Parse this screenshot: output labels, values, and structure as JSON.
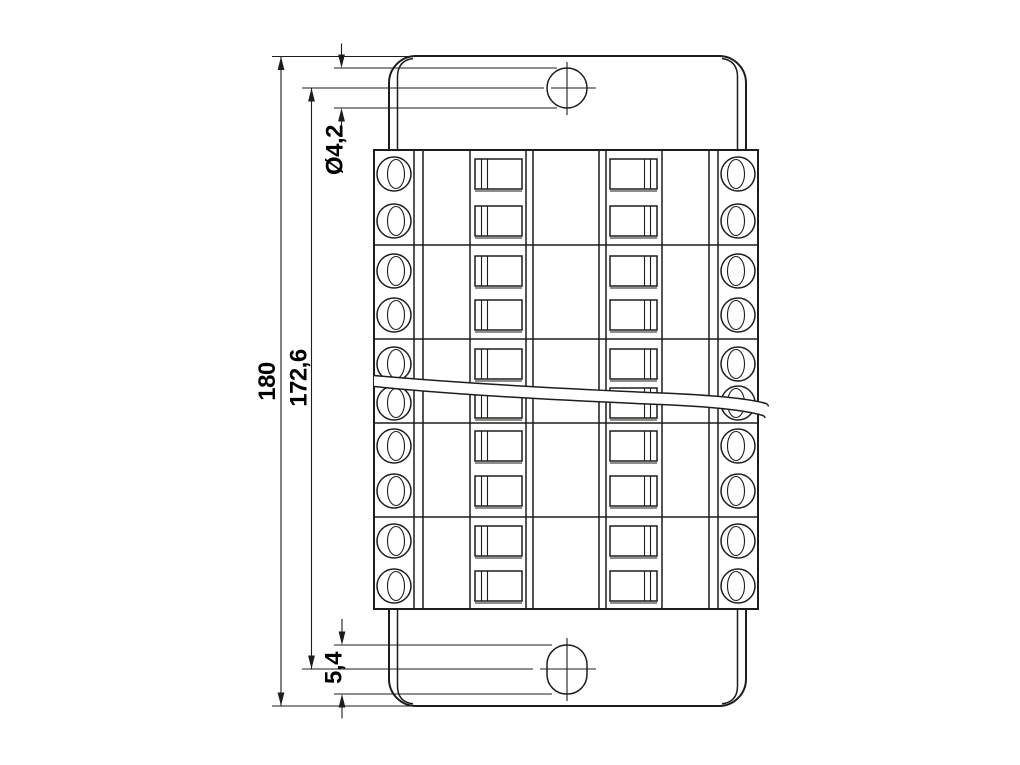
{
  "drawing": {
    "background_color": "#ffffff",
    "line_color": "#1d1d1b",
    "text_color": "#000000",
    "dimensions": {
      "overall_height": "180",
      "hole_center_spacing": "172,6",
      "hole_diameter": "Ø4,2",
      "slot_length": "5,4"
    },
    "structure": {
      "terminal_groups": 5,
      "terminals_per_group": 2,
      "terminal_rows": 10
    }
  }
}
